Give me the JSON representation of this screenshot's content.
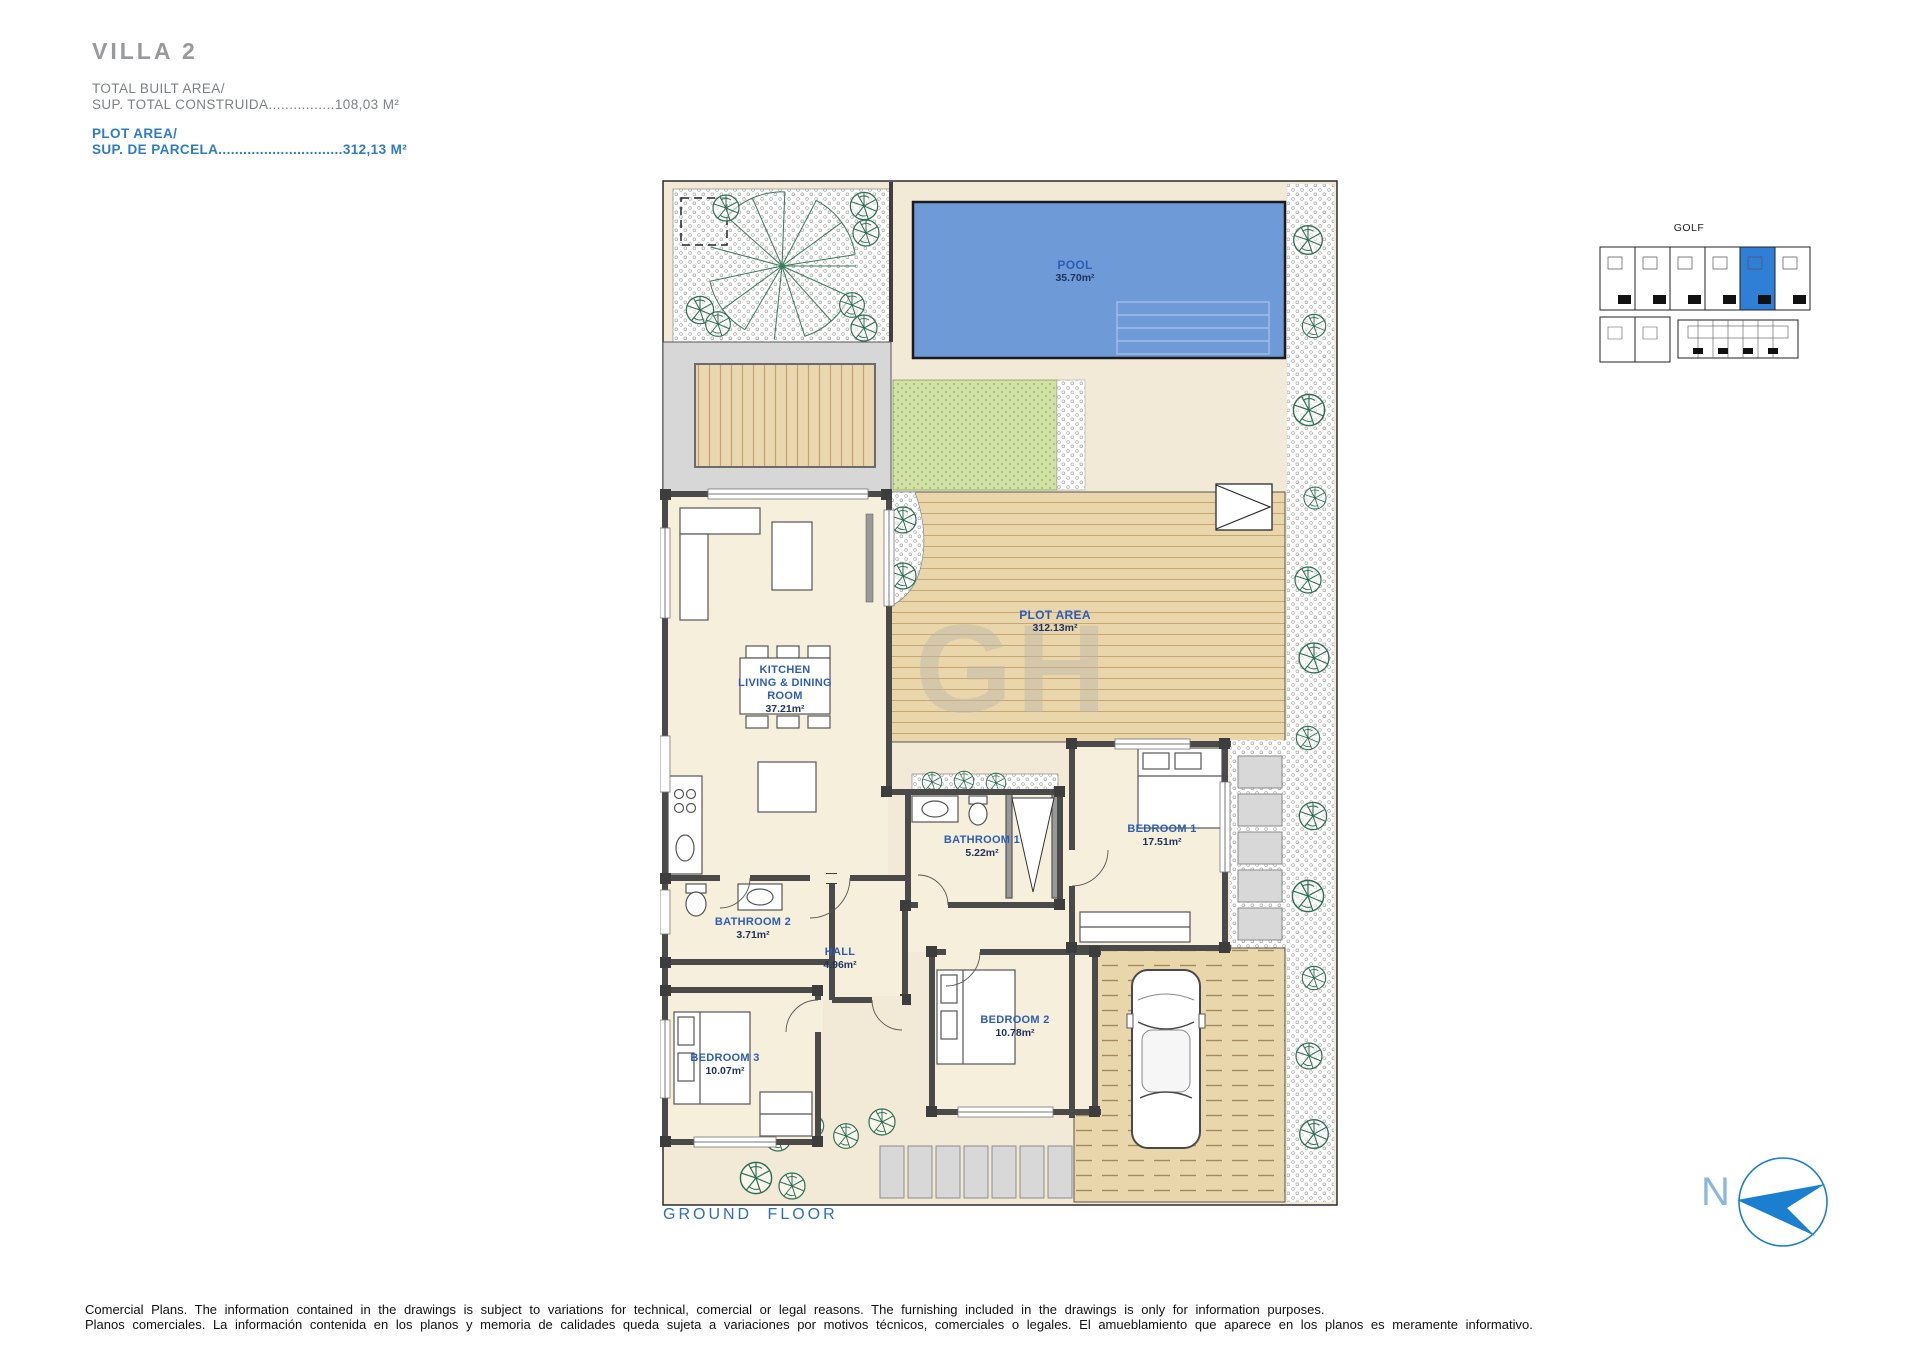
{
  "header": {
    "title": "VILLA 2",
    "built_area": {
      "label_en": "TOTAL BUILT AREA/",
      "label_es": "SUP. TOTAL CONSTRUIDA",
      "dots": "................",
      "value": "108,03 M²"
    },
    "plot_area": {
      "label_en": "PLOT AREA/",
      "label_es": "SUP. DE PARCELA",
      "dots": "..............................",
      "value": "312,13 M²"
    }
  },
  "plan": {
    "floor_label": "GROUND FLOOR",
    "watermark": "GH",
    "rooms": {
      "pool": {
        "name": "POOL",
        "area": "35.70m²"
      },
      "plot": {
        "name": "PLOT AREA",
        "area": "312.13m²"
      },
      "kitchen": {
        "name": "KITCHEN\nLIVING & DINING\nROOM",
        "area": "37.21m²"
      },
      "bathroom1": {
        "name": "BATHROOM 1",
        "area": "5.22m²"
      },
      "bedroom1": {
        "name": "BEDROOM 1",
        "area": "17.51m²"
      },
      "bathroom2": {
        "name": "BATHROOM 2",
        "area": "3.71m²"
      },
      "hall": {
        "name": "HALL",
        "area": "4.96m²"
      },
      "bedroom2": {
        "name": "BEDROOM 2",
        "area": "10.78m²"
      },
      "bedroom3": {
        "name": "BEDROOM 3",
        "area": "10.07m²"
      }
    }
  },
  "site_plan": {
    "label": "GOLF"
  },
  "compass": {
    "label": "N"
  },
  "footer": {
    "line_en": "Comercial Plans. The information contained in the drawings is subject to variations for technical, comercial or legal reasons. The furnishing included in the drawings is only for information purposes.",
    "line_es": "Planos comerciales. La información contenida en los planos y memoria de calidades queda sujeta a variaciones por motivos técnicos, comerciales o legales. El amueblamiento que aparece en los planos es meramente informativo."
  },
  "colors": {
    "accent_blue": "#2e7cc3",
    "room_name_blue": "#2d5cb8",
    "area_navy": "#1f3260",
    "pool_blue": "#6f9ad8",
    "compass_blue": "#1b7fd0",
    "site_highlight_blue": "#2f7fd6",
    "deck_tan": "#e9d6ab",
    "grass_green": "#d2e2a6",
    "wall_gray": "#4a4a4a"
  }
}
